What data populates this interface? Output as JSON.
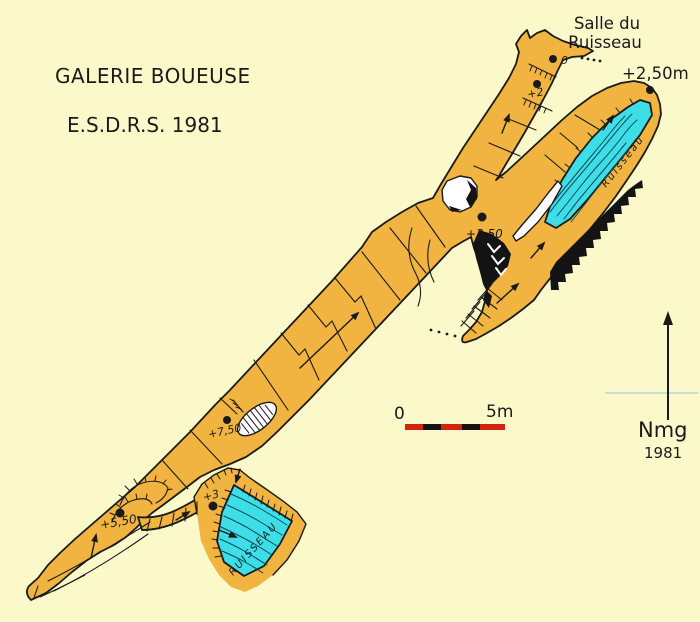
{
  "map": {
    "title": "GALERIE BOUEUSE",
    "subtitle": "E.S.D.R.S. 1981"
  },
  "annotations": {
    "salle_line1": "Salle du",
    "salle_line2": "Ruisseau",
    "entrance_elevation": "+2,50m",
    "stream_label_upper": "Ruisseau",
    "stream_label_lower": "RUISSEAU"
  },
  "stations": [
    {
      "label": "0"
    },
    {
      "label": "+2"
    },
    {
      "label": "+3,50"
    },
    {
      "label": "+7,50"
    },
    {
      "label": "+5,50"
    },
    {
      "label": "+3"
    }
  ],
  "scale_bar": {
    "zero_label": "0",
    "end_label": "5m"
  },
  "north_arrow": {
    "label": "Nmg",
    "year": "1981"
  },
  "colors": {
    "background": "#FBF8CA",
    "passage": "#F2B441",
    "water": "#3EDEE9",
    "ink": "#1A1A1A",
    "scale_red": "#D3230F",
    "fold_line": "#AFC7E4"
  }
}
